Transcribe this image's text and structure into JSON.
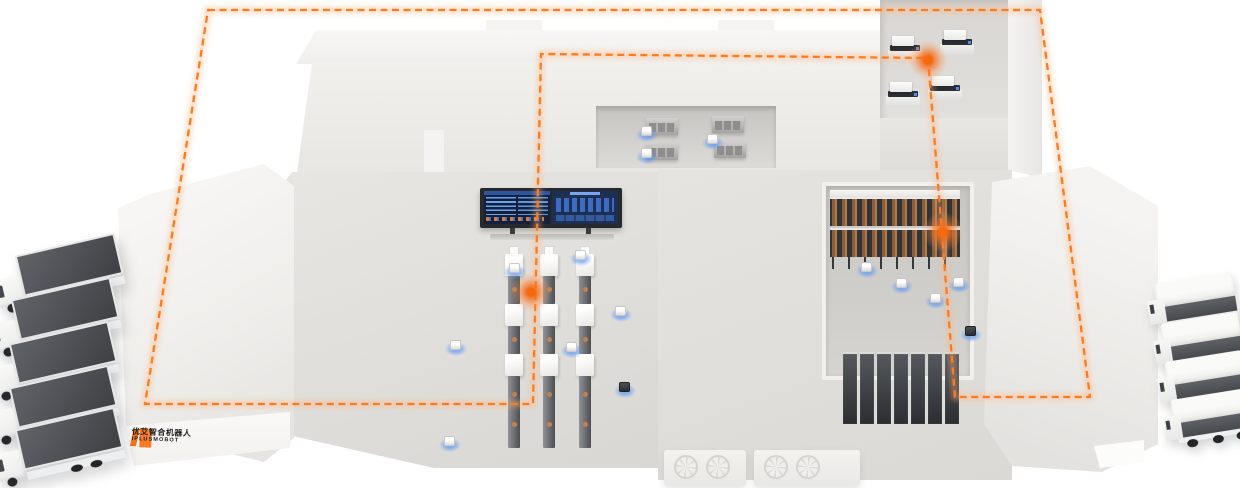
{
  "branding": {
    "company_cn": "优艾智合机器人",
    "company_en": "IPLUSMOBOT",
    "logo_mark_color": "#f97113"
  },
  "colors": {
    "accent_orange": "#ff7a1a",
    "glow_orange": "#f4690e",
    "background": "#ffffff",
    "building_white": "#f1f0ed",
    "floor_gray": "#dcdad6",
    "screen_navy": "#14213d",
    "screen_blue": "#4f8fe8",
    "truck_trailer_dark": "#4b4d50",
    "rack_dark": "#34373c",
    "rack_box_brown": "#a06a3e",
    "agv_glow_blue": "#5b9cf5"
  },
  "route": {
    "type": "closed-loop-dashed",
    "color": "#ff7a1a",
    "dash": "7 4.5",
    "path_d": "M208 10 L1040 10 L1090 397 L955 397 L928 58 L541 54 L533 404 L145 404 Z"
  },
  "scene": {
    "glow_markers": [
      {
        "x": 531,
        "y": 292
      },
      {
        "x": 928,
        "y": 60
      },
      {
        "x": 943,
        "y": 232
      }
    ],
    "left_trucks": [
      {
        "x": -6,
        "y": 246
      },
      {
        "x": -10,
        "y": 290
      },
      {
        "x": -12,
        "y": 334
      },
      {
        "x": -12,
        "y": 378
      },
      {
        "x": -6,
        "y": 420
      }
    ],
    "right_trucks": [
      {
        "x": 1148,
        "y": 278
      },
      {
        "x": 1154,
        "y": 318
      },
      {
        "x": 1158,
        "y": 356
      },
      {
        "x": 1164,
        "y": 394
      }
    ],
    "agv_robots": [
      {
        "x": 641,
        "y": 126,
        "v": "light"
      },
      {
        "x": 641,
        "y": 148,
        "v": "light"
      },
      {
        "x": 707,
        "y": 134,
        "v": "light"
      },
      {
        "x": 575,
        "y": 250,
        "v": "light"
      },
      {
        "x": 509,
        "y": 263,
        "v": "light"
      },
      {
        "x": 615,
        "y": 306,
        "v": "light"
      },
      {
        "x": 566,
        "y": 342,
        "v": "light"
      },
      {
        "x": 450,
        "y": 340,
        "v": "light"
      },
      {
        "x": 444,
        "y": 436,
        "v": "light"
      },
      {
        "x": 619,
        "y": 382,
        "v": "dark"
      },
      {
        "x": 861,
        "y": 262,
        "v": "light"
      },
      {
        "x": 896,
        "y": 278,
        "v": "light"
      },
      {
        "x": 930,
        "y": 293,
        "v": "light"
      },
      {
        "x": 953,
        "y": 277,
        "v": "light"
      },
      {
        "x": 965,
        "y": 326,
        "v": "dark"
      }
    ],
    "machine_columns": [
      {
        "x": 504
      },
      {
        "x": 539
      },
      {
        "x": 575
      }
    ],
    "pick_machines": [
      {
        "x": 886,
        "y": 36
      },
      {
        "x": 938,
        "y": 30
      },
      {
        "x": 884,
        "y": 82
      },
      {
        "x": 926,
        "y": 76
      }
    ],
    "cabinets": [
      {
        "x": 646,
        "y": 118
      },
      {
        "x": 712,
        "y": 116
      },
      {
        "x": 646,
        "y": 143
      },
      {
        "x": 714,
        "y": 141
      }
    ],
    "rack_units_bottom": 7,
    "fan_blocks": [
      {
        "x": 664,
        "y": 450,
        "w": 82
      },
      {
        "x": 754,
        "y": 450,
        "w": 106
      }
    ]
  }
}
